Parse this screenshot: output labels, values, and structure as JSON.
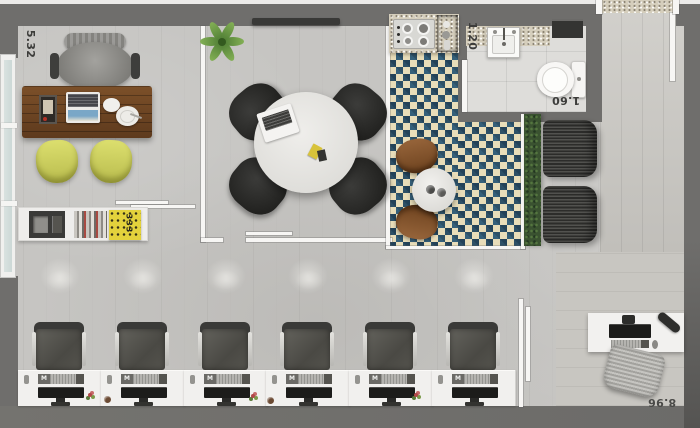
{
  "dims": {
    "left_wall": "5.32",
    "bath_width": "1.20",
    "bath_length": "1.60",
    "bottom_wall": "8.96"
  },
  "labels": {
    "keyboard_logo": "M",
    "book_spine": "333"
  },
  "colors": {
    "wall_gray": "#6f6e6c",
    "floor_concrete": "#c6c5c2",
    "checker_teal": "#2d5066",
    "checker_beige": "#e8ddb9",
    "accent_yellow": "#d4d75f",
    "hedge_green": "#3a5230",
    "desk_wood": "#6e4526",
    "chair_black": "#2c2c2a"
  }
}
